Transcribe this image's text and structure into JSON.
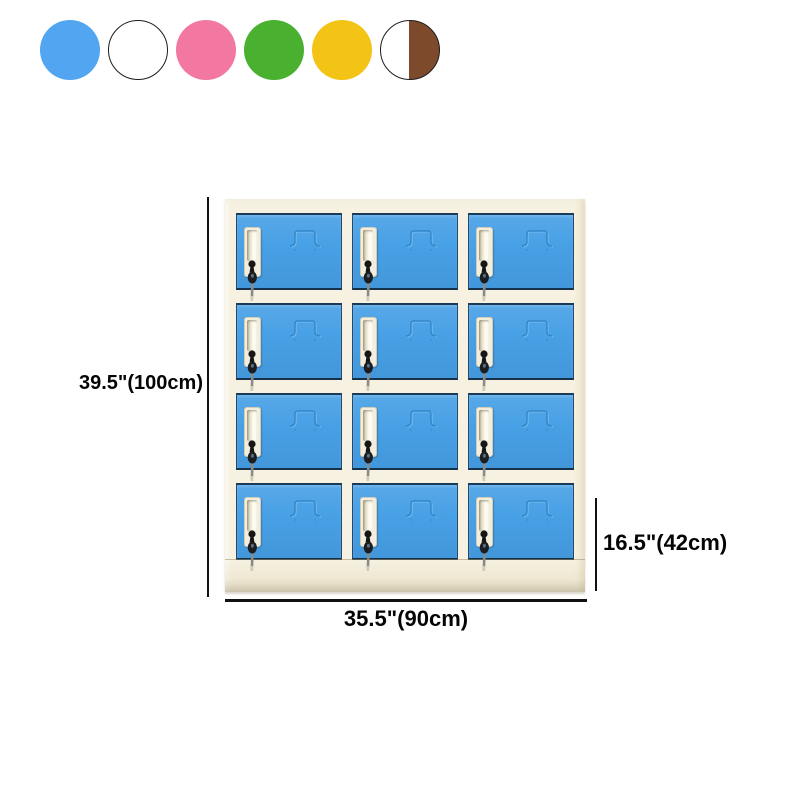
{
  "product_view": {
    "swatches": {
      "items": [
        {
          "name": "blue",
          "type": "solid",
          "color": "#52a5f0",
          "outlined": false
        },
        {
          "name": "white",
          "type": "solid",
          "color": "#ffffff",
          "outlined": true
        },
        {
          "name": "pink",
          "type": "solid",
          "color": "#f278a1",
          "outlined": false
        },
        {
          "name": "green",
          "type": "solid",
          "color": "#4ab030",
          "outlined": false
        },
        {
          "name": "yellow",
          "type": "solid",
          "color": "#f3c315",
          "outlined": false
        },
        {
          "name": "white-brown",
          "type": "split",
          "color": "#ffffff",
          "color2": "#7d4a2b",
          "outlined": true
        }
      ]
    },
    "locker": {
      "rows": 4,
      "columns": 3,
      "compartment_count": 12,
      "door_color": "#459fe5",
      "frame_color": "#f6f1e0",
      "accent_dark": "#1a3a58"
    },
    "dimensions": {
      "height_label": "39.5\"(100cm)",
      "width_label": "35.5\"(90cm)",
      "depth_label": "16.5\"(42cm)"
    }
  }
}
